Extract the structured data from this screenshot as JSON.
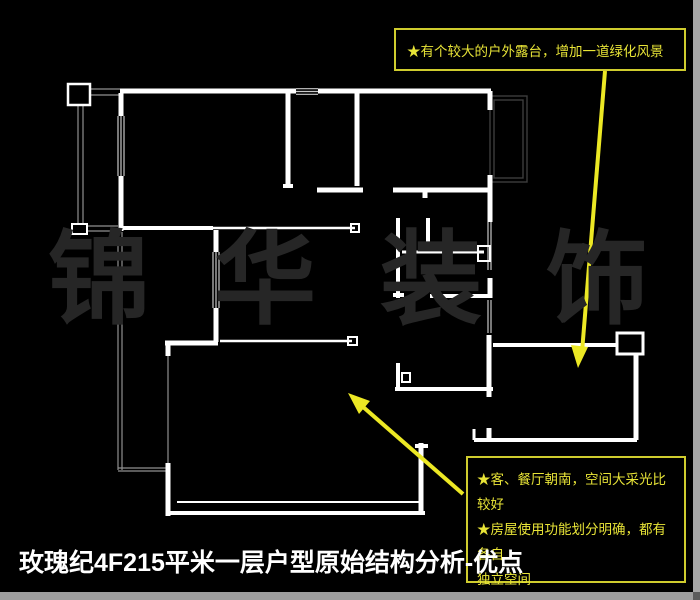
{
  "title": {
    "text": "玫瑰纪4F215平米一层户型原始结构分析-优点"
  },
  "watermark": {
    "characters": [
      "锦",
      "华",
      "装",
      "饰"
    ]
  },
  "notes": {
    "terrace_note": {
      "text": "★有个较大的户外露台，增加一道绿化风景"
    },
    "advantages_note": {
      "lines": [
        "★客、餐厅朝南，空间大采光比较好",
        "★房屋使用功能划分明确，都有各自",
        "独立空间",
        "★储藏空间较多，很有实用价值"
      ]
    }
  },
  "colors": {
    "background": "#000000",
    "wall": "#ffffff",
    "window_line": "#c9c9c9",
    "thin_line": "#8f8f8f",
    "balcony_gray": "#3d3d3d",
    "note_border": "#cfcc2e",
    "note_text": "#e8e437",
    "arrow": "#ece824",
    "title_text": "#ffffff",
    "watermark_text": "#262626",
    "edge_strip": "#a6a6a6"
  },
  "floorplan": {
    "walls": [
      [
        120,
        91,
        296,
        91,
        5
      ],
      [
        318,
        91,
        491,
        91,
        5
      ],
      [
        121,
        93,
        121,
        116,
        5
      ],
      [
        121,
        176,
        121,
        231,
        5
      ],
      [
        288,
        93,
        288,
        186,
        5
      ],
      [
        283,
        186,
        293,
        186,
        4
      ],
      [
        357,
        93,
        357,
        186,
        5
      ],
      [
        317,
        190,
        363,
        190,
        5
      ],
      [
        393,
        190,
        490,
        190,
        5
      ],
      [
        425,
        192,
        425,
        198,
        5
      ],
      [
        490,
        91,
        490,
        110,
        5
      ],
      [
        490,
        175,
        490,
        222,
        5
      ],
      [
        398,
        218,
        398,
        298,
        4
      ],
      [
        393,
        295,
        404,
        295,
        4
      ],
      [
        428,
        218,
        428,
        250,
        4
      ],
      [
        402,
        252,
        484,
        252,
        3
      ],
      [
        430,
        296,
        490,
        296,
        4
      ],
      [
        490,
        278,
        490,
        298,
        5
      ],
      [
        121,
        228,
        213,
        228,
        4
      ],
      [
        213,
        228,
        355,
        228,
        2.5
      ],
      [
        216,
        230,
        216,
        252,
        5
      ],
      [
        216,
        308,
        216,
        342,
        5
      ],
      [
        220,
        341,
        352,
        341,
        2.5
      ],
      [
        165,
        343,
        218,
        343,
        5
      ],
      [
        168,
        345,
        168,
        356,
        5
      ],
      [
        168,
        463,
        168,
        516,
        5
      ],
      [
        166,
        513,
        425,
        513,
        4
      ],
      [
        177,
        502,
        419,
        502,
        2
      ],
      [
        421,
        443,
        421,
        513,
        5
      ],
      [
        415,
        446,
        428,
        446,
        4
      ],
      [
        398,
        363,
        398,
        391,
        4
      ],
      [
        395,
        389,
        493,
        389,
        4
      ],
      [
        489,
        335,
        489,
        397,
        5
      ],
      [
        493,
        345,
        617,
        345,
        4
      ],
      [
        636,
        354,
        636,
        440,
        5
      ],
      [
        474,
        440,
        637,
        440,
        4
      ],
      [
        474,
        429,
        474,
        440,
        3
      ],
      [
        489,
        428,
        489,
        440,
        5
      ]
    ],
    "window_lines": [
      [
        296,
        88.7,
        318,
        88.7
      ],
      [
        296,
        91.5,
        318,
        91.5
      ],
      [
        296,
        94.3,
        318,
        94.3
      ],
      [
        118,
        116,
        118,
        176
      ],
      [
        121,
        116,
        121,
        176
      ],
      [
        124,
        116,
        124,
        176
      ],
      [
        213,
        252,
        213,
        308
      ],
      [
        216,
        252,
        216,
        308
      ],
      [
        219,
        252,
        219,
        308
      ],
      [
        488,
        222,
        488,
        270
      ],
      [
        491,
        222,
        491,
        270
      ],
      [
        488,
        300,
        488,
        333
      ],
      [
        491,
        300,
        491,
        333
      ]
    ],
    "thin_lines": [
      [
        90,
        89,
        120,
        89
      ],
      [
        90,
        95,
        120,
        95
      ],
      [
        78,
        105,
        78,
        224
      ],
      [
        83,
        105,
        83,
        224
      ],
      [
        87,
        226,
        118,
        226
      ],
      [
        87,
        231,
        118,
        231
      ],
      [
        118,
        232,
        118,
        470
      ],
      [
        122,
        232,
        122,
        470
      ],
      [
        118,
        468,
        166,
        468
      ],
      [
        118,
        471,
        166,
        471
      ],
      [
        168,
        356,
        168,
        463
      ]
    ],
    "squares": [
      [
        68,
        84,
        22,
        21,
        2.5
      ],
      [
        72,
        224,
        15,
        10,
        2
      ],
      [
        351,
        224,
        8,
        8,
        2
      ],
      [
        348,
        337,
        9,
        8,
        2
      ],
      [
        402,
        373,
        8,
        9,
        2
      ],
      [
        478,
        246,
        12,
        15,
        2
      ],
      [
        617,
        333,
        26,
        21,
        3
      ]
    ],
    "gray_rects": [
      [
        490,
        96,
        37,
        86
      ],
      [
        494,
        100,
        29,
        78
      ]
    ],
    "arrows": [
      {
        "line": [
          605,
          71,
          582,
          352
        ],
        "head": "578,368 588,347 571,345"
      },
      {
        "line": [
          463,
          494,
          362,
          406
        ],
        "head": "348,393 370,401 359,414"
      }
    ]
  }
}
